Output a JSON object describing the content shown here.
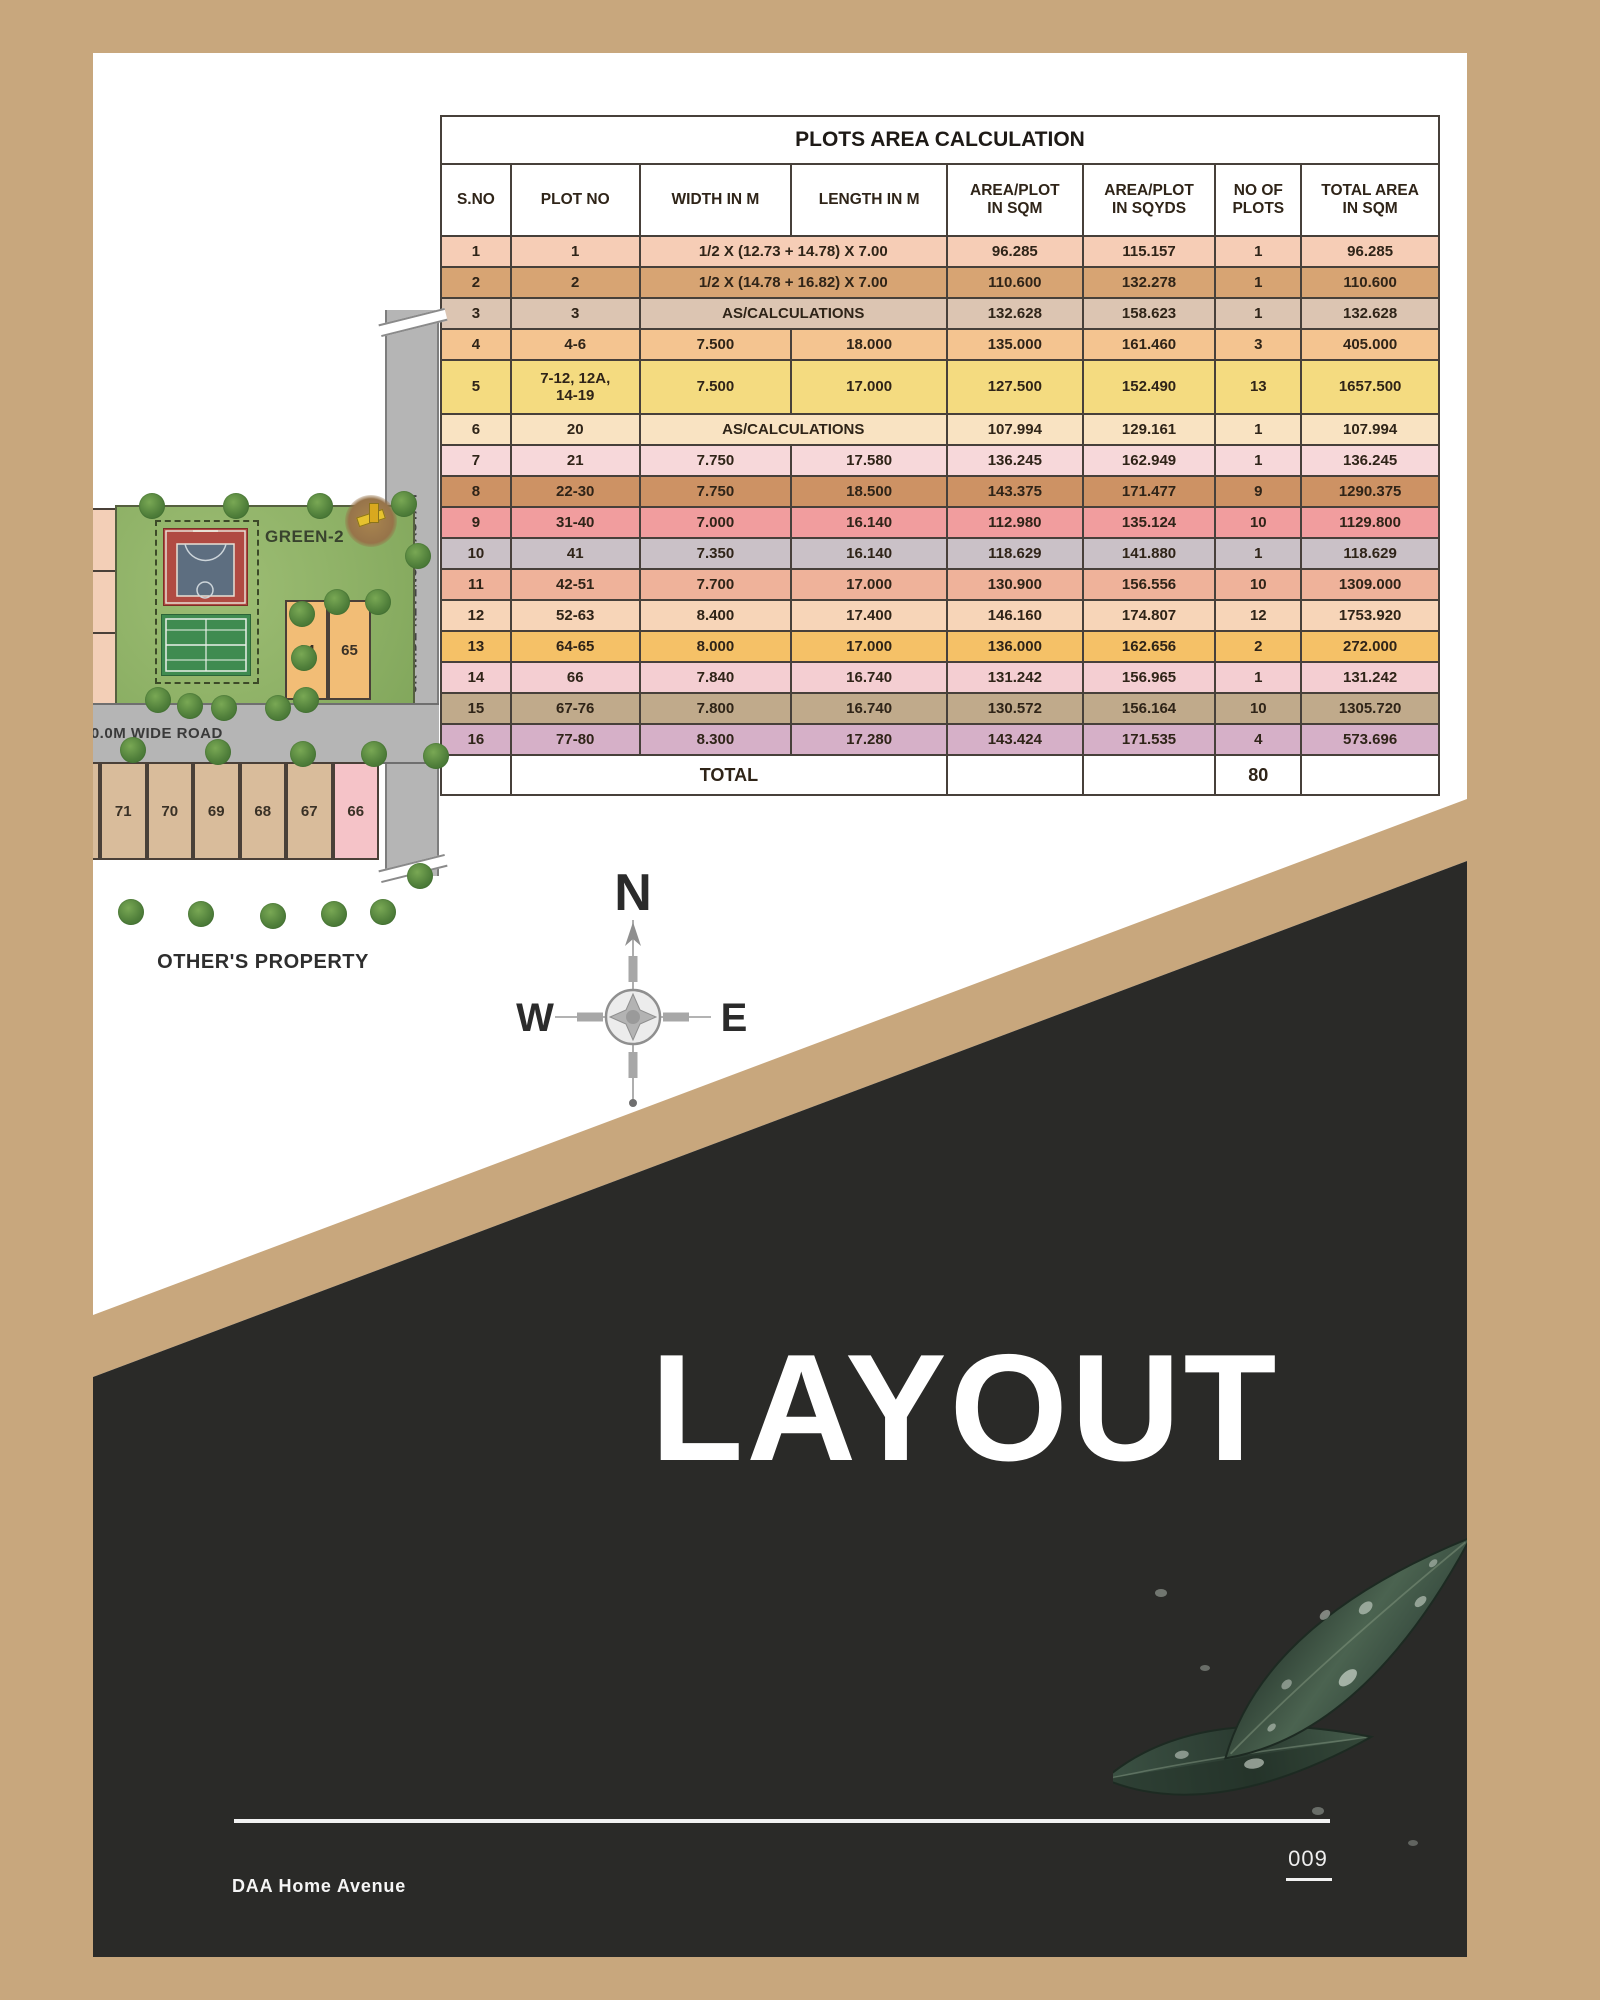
{
  "colors": {
    "frame_tan": "#c8a77d",
    "dark_section": "#2a2a28",
    "road_gray": "#b5b5b5",
    "park_green": "#8fb267",
    "plot_orange": "#f2bd76",
    "plot_tan": "#d9bc9b",
    "plot_pink": "#f5c3c8"
  },
  "table": {
    "title": "PLOTS AREA CALCULATION",
    "headers": [
      "S.NO",
      "PLOT NO",
      "WIDTH IN M",
      "LENGTH IN M",
      "AREA/PLOT\nIN SQM",
      "AREA/PLOT\nIN SQYDS",
      "NO OF\nPLOTS",
      "TOTAL AREA\nIN SQM"
    ],
    "rows": [
      {
        "sno": "1",
        "plot": "1",
        "merged": "1/2 X (12.73 + 14.78) X 7.00",
        "sqm": "96.285",
        "sqyds": "115.157",
        "count": "1",
        "total": "96.285",
        "bg": "#f6cdb6"
      },
      {
        "sno": "2",
        "plot": "2",
        "merged": "1/2 X (14.78 + 16.82) X 7.00",
        "sqm": "110.600",
        "sqyds": "132.278",
        "count": "1",
        "total": "110.600",
        "bg": "#d7a473"
      },
      {
        "sno": "3",
        "plot": "3",
        "merged": "AS/CALCULATIONS",
        "sqm": "132.628",
        "sqyds": "158.623",
        "count": "1",
        "total": "132.628",
        "bg": "#dcc5b2"
      },
      {
        "sno": "4",
        "plot": "4-6",
        "width": "7.500",
        "length": "18.000",
        "sqm": "135.000",
        "sqyds": "161.460",
        "count": "3",
        "total": "405.000",
        "bg": "#f4c490"
      },
      {
        "sno": "5",
        "plot": "7-12, 12A,\n14-19",
        "width": "7.500",
        "length": "17.000",
        "sqm": "127.500",
        "sqyds": "152.490",
        "count": "13",
        "total": "1657.500",
        "bg": "#f4db80",
        "tall": true
      },
      {
        "sno": "6",
        "plot": "20",
        "merged": "AS/CALCULATIONS",
        "sqm": "107.994",
        "sqyds": "129.161",
        "count": "1",
        "total": "107.994",
        "bg": "#f9e3c2"
      },
      {
        "sno": "7",
        "plot": "21",
        "width": "7.750",
        "length": "17.580",
        "sqm": "136.245",
        "sqyds": "162.949",
        "count": "1",
        "total": "136.245",
        "bg": "#f7d8da"
      },
      {
        "sno": "8",
        "plot": "22-30",
        "width": "7.750",
        "length": "18.500",
        "sqm": "143.375",
        "sqyds": "171.477",
        "count": "9",
        "total": "1290.375",
        "bg": "#cd9264"
      },
      {
        "sno": "9",
        "plot": "31-40",
        "width": "7.000",
        "length": "16.140",
        "sqm": "112.980",
        "sqyds": "135.124",
        "count": "10",
        "total": "1129.800",
        "bg": "#f19d9e"
      },
      {
        "sno": "10",
        "plot": "41",
        "width": "7.350",
        "length": "16.140",
        "sqm": "118.629",
        "sqyds": "141.880",
        "count": "1",
        "total": "118.629",
        "bg": "#cac1c7"
      },
      {
        "sno": "11",
        "plot": "42-51",
        "width": "7.700",
        "length": "17.000",
        "sqm": "130.900",
        "sqyds": "156.556",
        "count": "10",
        "total": "1309.000",
        "bg": "#efb29a"
      },
      {
        "sno": "12",
        "plot": "52-63",
        "width": "8.400",
        "length": "17.400",
        "sqm": "146.160",
        "sqyds": "174.807",
        "count": "12",
        "total": "1753.920",
        "bg": "#f7d5b8"
      },
      {
        "sno": "13",
        "plot": "64-65",
        "width": "8.000",
        "length": "17.000",
        "sqm": "136.000",
        "sqyds": "162.656",
        "count": "2",
        "total": "272.000",
        "bg": "#f5c167"
      },
      {
        "sno": "14",
        "plot": "66",
        "width": "7.840",
        "length": "16.740",
        "sqm": "131.242",
        "sqyds": "156.965",
        "count": "1",
        "total": "131.242",
        "bg": "#f4ced2"
      },
      {
        "sno": "15",
        "plot": "67-76",
        "width": "7.800",
        "length": "16.740",
        "sqm": "130.572",
        "sqyds": "156.164",
        "count": "10",
        "total": "1305.720",
        "bg": "#c0aa8b"
      },
      {
        "sno": "16",
        "plot": "77-80",
        "width": "8.300",
        "length": "17.280",
        "sqm": "143.424",
        "sqyds": "171.535",
        "count": "4",
        "total": "573.696",
        "bg": "#d6b0c8"
      }
    ],
    "total_label": "TOTAL",
    "total_plots": "80"
  },
  "site_plan": {
    "green_label": "GREEN-2",
    "vertical_road_label": "3K WIDE REVENUE RASTAH",
    "horizontal_road_label": "30.0M WIDE ROAD",
    "others_property_label": "OTHER'S PROPERTY",
    "plots_right": [
      "64",
      "65"
    ],
    "plots_bottom": [
      "71",
      "70",
      "69",
      "68",
      "67",
      "66"
    ]
  },
  "compass": {
    "north": "N",
    "west": "W",
    "east": "E"
  },
  "hero": {
    "title": "LAYOUT"
  },
  "footer": {
    "brand": "DAA Home Avenue",
    "page_number": "009"
  }
}
